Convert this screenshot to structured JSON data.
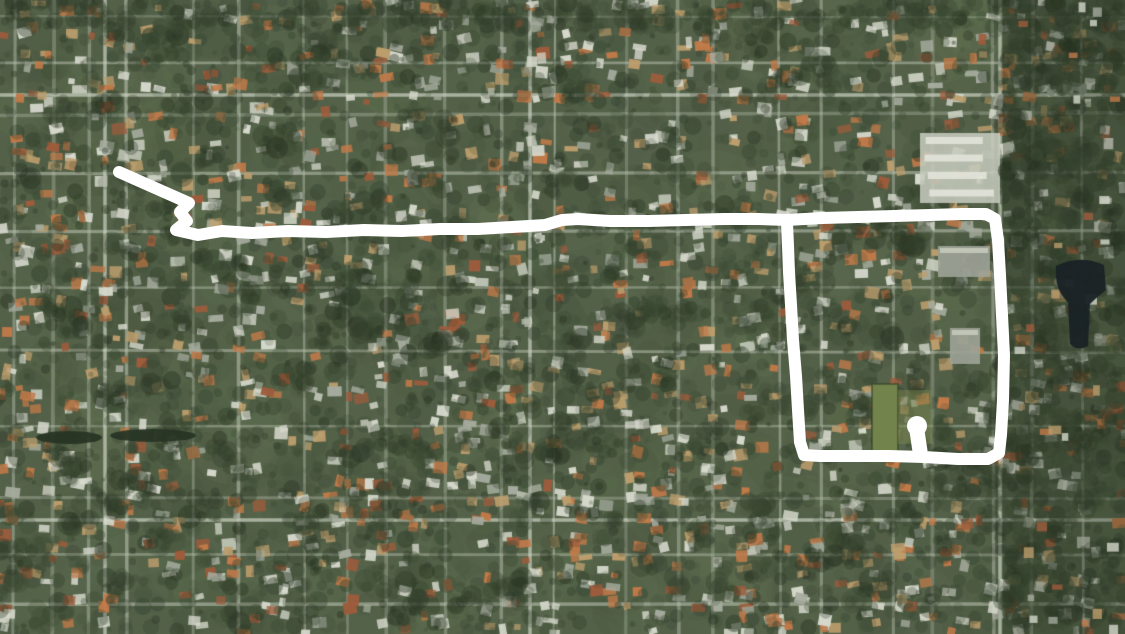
{
  "map": {
    "type": "satellite-aerial",
    "description": "Aerial imagery of a dense tree-covered suburban residential grid with a hand-drawn white route annotation",
    "width": 1125,
    "height": 634,
    "palette": {
      "base_green": "#4d5a42",
      "green_light": "#647450",
      "green_mid": "#55654a",
      "green_dark": "#39472f",
      "canopy_dark": "#27331f",
      "canopy_deep": "#1d2817",
      "grass_bright": "#6d7e45",
      "street": "#b9c0af",
      "street_bright": "#ccd2c2",
      "roof_white": "#d6d8cc",
      "roof_tan": "#bb9a68",
      "roof_orange": "#c07442",
      "roof_rust": "#9b5534",
      "roof_gray": "#a3a89b",
      "water_dark": "#10181c",
      "canal_dark": "#1d2a1b",
      "haze": "rgba(224,228,217,0.05)"
    },
    "major_streets": {
      "vertical": [
        105,
        530,
        1000
      ],
      "horizontal": [
        95,
        520
      ]
    },
    "features": {
      "lake": {
        "x": 1056,
        "y": 260,
        "w": 48,
        "h": 86
      },
      "canal_segments": [
        {
          "x": 36,
          "y": 431,
          "w": 66,
          "h": 13
        },
        {
          "x": 110,
          "y": 429,
          "w": 86,
          "h": 13
        }
      ],
      "field": {
        "x": 872,
        "y": 384,
        "w": 26,
        "h": 72
      },
      "campus_blocks": [
        {
          "x": 920,
          "y": 133,
          "w": 80,
          "h": 70,
          "style": "rows"
        },
        {
          "x": 938,
          "y": 246,
          "w": 52,
          "h": 31,
          "style": "gray"
        },
        {
          "x": 950,
          "y": 328,
          "w": 30,
          "h": 36,
          "style": "gray"
        }
      ],
      "forest_band": {
        "x": 1003,
        "y": 0,
        "w": 122,
        "h": 634
      }
    }
  },
  "route": {
    "color": "#ffffff",
    "stroke_width": 12,
    "points": [
      [
        119,
        172
      ],
      [
        189,
        203
      ],
      [
        180,
        212
      ],
      [
        187,
        221
      ],
      [
        176,
        230
      ],
      [
        198,
        235
      ],
      [
        222,
        231
      ],
      [
        252,
        233
      ],
      [
        288,
        231
      ],
      [
        326,
        232
      ],
      [
        364,
        230
      ],
      [
        402,
        231
      ],
      [
        440,
        229
      ],
      [
        478,
        229
      ],
      [
        512,
        227
      ],
      [
        545,
        225
      ],
      [
        562,
        220
      ],
      [
        578,
        219
      ],
      [
        610,
        221
      ],
      [
        648,
        221
      ],
      [
        686,
        220
      ],
      [
        724,
        219
      ],
      [
        758,
        219
      ],
      [
        787,
        220
      ],
      [
        822,
        218
      ],
      [
        858,
        217
      ],
      [
        894,
        216
      ],
      [
        930,
        215
      ],
      [
        962,
        214
      ],
      [
        986,
        214
      ],
      [
        995,
        219
      ],
      [
        998,
        240
      ],
      [
        1000,
        275
      ],
      [
        1002,
        315
      ],
      [
        1004,
        355
      ],
      [
        1003,
        400
      ],
      [
        1001,
        435
      ],
      [
        999,
        453
      ],
      [
        988,
        459
      ],
      [
        958,
        459
      ],
      [
        924,
        457
      ],
      [
        888,
        456
      ],
      [
        852,
        456
      ],
      [
        820,
        456
      ],
      [
        804,
        455
      ],
      [
        800,
        442
      ],
      [
        798,
        410
      ],
      [
        796,
        376
      ],
      [
        793,
        340
      ],
      [
        791,
        305
      ],
      [
        789,
        272
      ],
      [
        788,
        246
      ],
      [
        787,
        223
      ]
    ],
    "endpoint_spur": {
      "from": [
        920,
        451
      ],
      "to": [
        917,
        431
      ],
      "stroke_width": 15,
      "blob": {
        "cx": 917,
        "cy": 426,
        "r": 10
      }
    }
  }
}
